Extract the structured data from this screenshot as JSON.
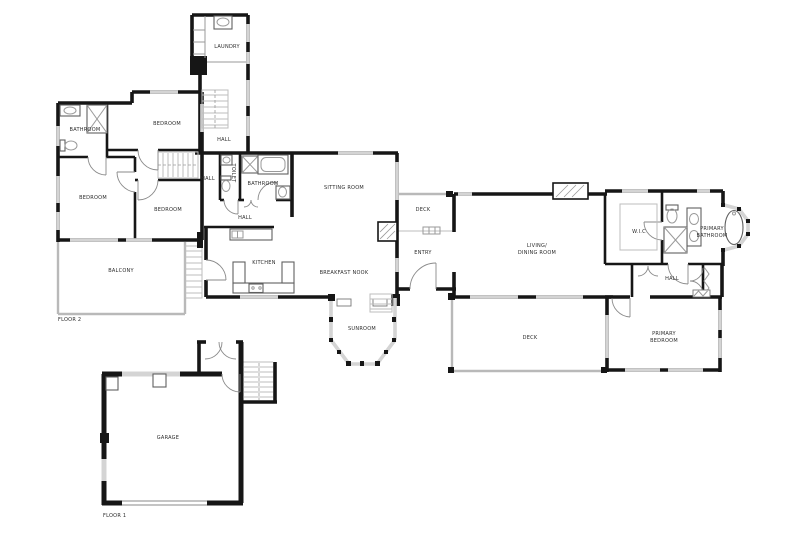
{
  "colors": {
    "wall": "#161616",
    "window": "#d4d4d4",
    "fixture": "#9a9a9a",
    "stair": "#bdbdbd",
    "text": "#2b2b2b"
  },
  "floors": {
    "floor1": "FLOOR 1",
    "floor2": "FLOOR 2"
  },
  "rooms": {
    "laundry": "LAUNDRY",
    "hall_stair": "HALL",
    "bathroom_upper": "BATHROOM",
    "bedroom_top": "BEDROOM",
    "bedroom_left": "BEDROOM",
    "bedroom_mid": "BEDROOM",
    "balcony": "BALCONY",
    "hall_mid": "HALL",
    "toilet": "TOILET",
    "bathroom_mid": "BATHROOM",
    "hall_lower": "HALL",
    "sitting_room": "SITTING ROOM",
    "kitchen": "KITCHEN",
    "breakfast_nook": "BREAKFAST NOOK",
    "sunroom": "SUNROOM",
    "deck_upper": "DECK",
    "entry": "ENTRY",
    "living_line1": "LIVING/",
    "living_line2": "DINING ROOM",
    "wic": "W.I.C",
    "primary_bath_line1": "PRIMARY",
    "primary_bath_line2": "BATHROOM",
    "hall_right": "HALL",
    "deck_lower": "DECK",
    "primary_bed_line1": "PRIMARY",
    "primary_bed_line2": "BEDROOM",
    "garage": "GARAGE"
  }
}
